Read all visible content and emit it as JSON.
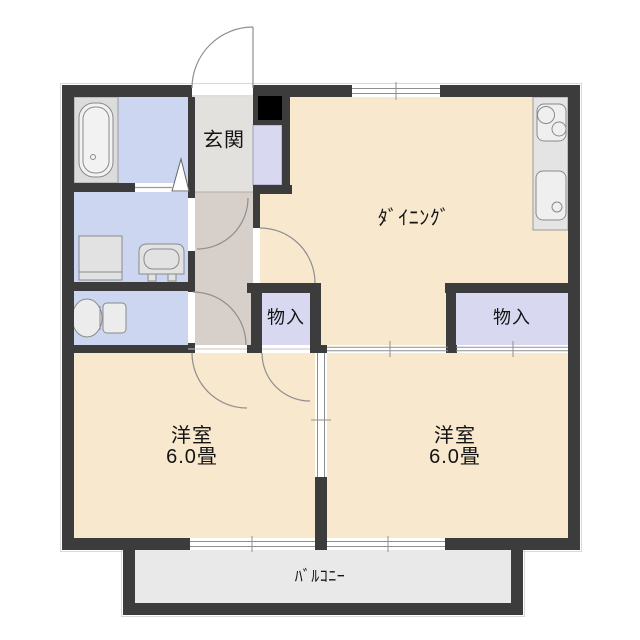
{
  "plan": {
    "type": "apartment-floor-plan",
    "labels": {
      "genkan": "玄関",
      "dining": "ﾀﾞｲﾆﾝｸﾞ",
      "closet_left": "物入",
      "closet_right": "物入",
      "bedroom_left_name": "洋室",
      "bedroom_left_size": "6.0畳",
      "bedroom_right_name": "洋室",
      "bedroom_right_size": "6.0畳",
      "balcony": "ﾊﾞﾙｺﾆｰ"
    },
    "fixtures": [
      "bathtub-icon",
      "washing-machine-icon",
      "vanity-icon",
      "toilet-icon",
      "stove-icon",
      "kitchen-sink-icon",
      "pipe-shaft"
    ],
    "colors": {
      "wall": "#3c3c3c",
      "room_floor": "#f8e8cd",
      "wet_area_floor": "#ccd6f1",
      "closet_floor": "#d8d8f1",
      "hall_floor": "#d7cfc9",
      "entry_floor": "#e3e1de",
      "balcony_floor": "#e9e9e9",
      "kitchen_counter": "#e4e4e4",
      "pipe_shaft": "#000000",
      "background": "#ffffff"
    }
  }
}
